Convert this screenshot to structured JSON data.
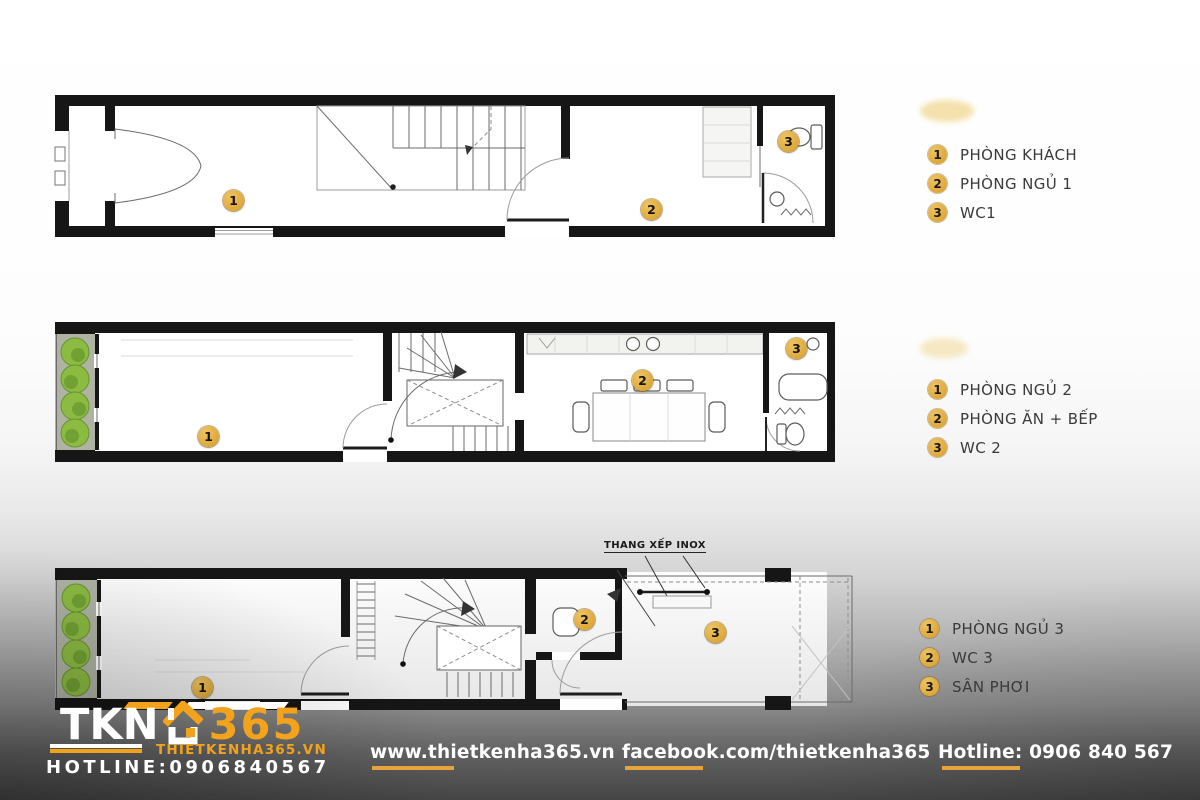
{
  "colors": {
    "accent": "#F2A31B",
    "badge": "#DFA93E"
  },
  "plans": [
    {
      "id": "floor-1",
      "markers": [
        "1",
        "2",
        "3"
      ],
      "legend": [
        {
          "num": "1",
          "label": "PHÒNG KHÁCH"
        },
        {
          "num": "2",
          "label": "PHÒNG NGỦ 1"
        },
        {
          "num": "3",
          "label": "WC1"
        }
      ]
    },
    {
      "id": "floor-2",
      "markers": [
        "1",
        "2",
        "3"
      ],
      "legend": [
        {
          "num": "1",
          "label": "PHÒNG NGỦ 2"
        },
        {
          "num": "2",
          "label": "PHÒNG ĂN + BẾP"
        },
        {
          "num": "3",
          "label": "WC 2"
        }
      ]
    },
    {
      "id": "floor-3",
      "markers": [
        "1",
        "2",
        "3"
      ],
      "annotation": "THANG XẾP INOX",
      "legend": [
        {
          "num": "1",
          "label": "PHÒNG NGỦ 3"
        },
        {
          "num": "2",
          "label": "WC 3"
        },
        {
          "num": "3",
          "label": "SÂN PHƠI"
        }
      ]
    }
  ],
  "logo": {
    "prefix": "TKN",
    "suffix": "365",
    "website": "THIETKENHA365.VN",
    "hotline": "HOTLINE:0906840567"
  },
  "footer": {
    "website": "www.thietkenha365.vn",
    "facebook": "facebook.com/thietkenha365",
    "hotline": "Hotline: 0906 840 567"
  }
}
